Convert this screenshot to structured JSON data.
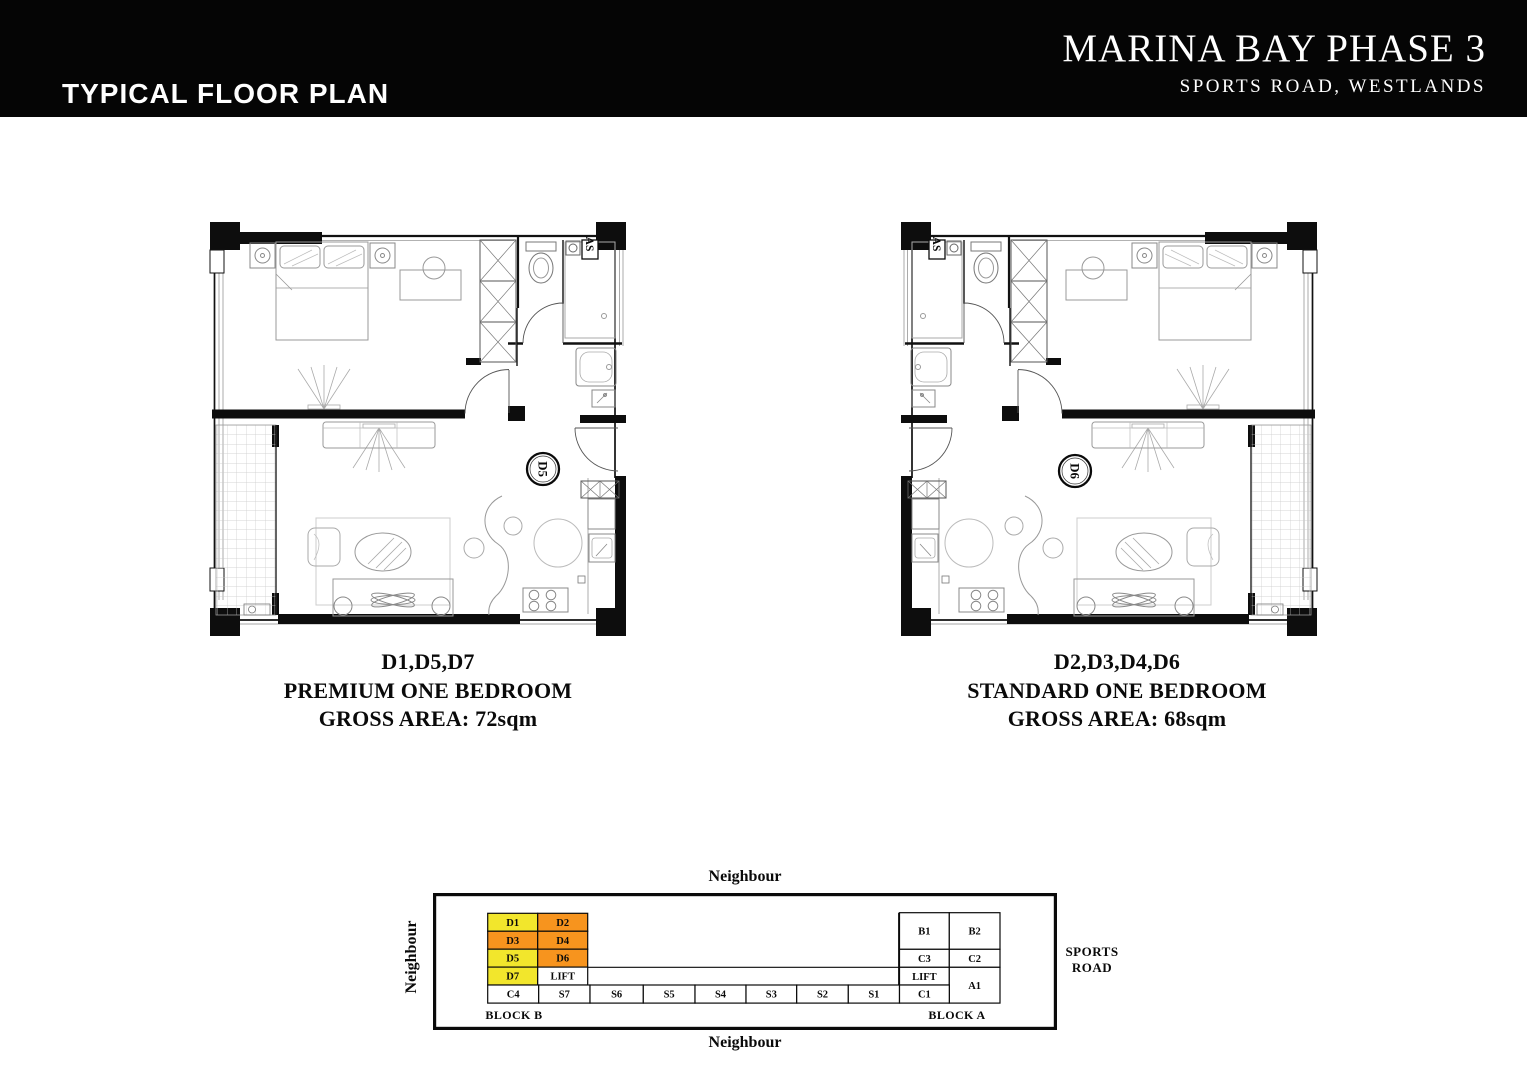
{
  "header": {
    "section_title": "TYPICAL FLOOR PLAN",
    "project_title": "MARINA BAY PHASE 3",
    "project_subtitle": "SPORTS ROAD, WESTLANDS"
  },
  "plans": [
    {
      "unit_label": "D5",
      "fixture_label": "AS",
      "caption": {
        "units": "D1,D5,D7",
        "type": "PREMIUM ONE BEDROOM",
        "area": "GROSS AREA: 72sqm"
      }
    },
    {
      "unit_label": "D6",
      "fixture_label": "AS",
      "caption": {
        "units": "D2,D3,D4,D6",
        "type": "STANDARD ONE BEDROOM",
        "area": "GROSS AREA: 68sqm"
      }
    }
  ],
  "key_plan": {
    "neighbour_top": "Neighbour",
    "neighbour_bottom": "Neighbour",
    "neighbour_left": "Neighbour",
    "road_label": [
      "SPORTS",
      "ROAD"
    ],
    "colors": {
      "yellow": "#f2e62c",
      "orange": "#f7941e",
      "white": "#ffffff"
    },
    "block_b": {
      "label": "BLOCK B",
      "unit_grid": [
        [
          {
            "id": "D1",
            "color": "yellow"
          },
          {
            "id": "D2",
            "color": "orange"
          }
        ],
        [
          {
            "id": "D3",
            "color": "orange"
          },
          {
            "id": "D4",
            "color": "orange"
          }
        ],
        [
          {
            "id": "D5",
            "color": "yellow"
          },
          {
            "id": "D6",
            "color": "orange"
          }
        ],
        [
          {
            "id": "D7",
            "color": "yellow"
          },
          {
            "id": "LIFT",
            "color": "white"
          }
        ]
      ],
      "bottom_row": [
        "C4",
        "S7",
        "S6",
        "S5",
        "S4",
        "S3",
        "S2",
        "S1"
      ]
    },
    "block_a": {
      "label": "BLOCK A",
      "cells": [
        {
          "id": "B1"
        },
        {
          "id": "B2"
        },
        {
          "id": "C3"
        },
        {
          "id": "C2"
        },
        {
          "id": "LIFT"
        },
        {
          "id": "A1"
        },
        {
          "id": "C1"
        }
      ]
    }
  }
}
